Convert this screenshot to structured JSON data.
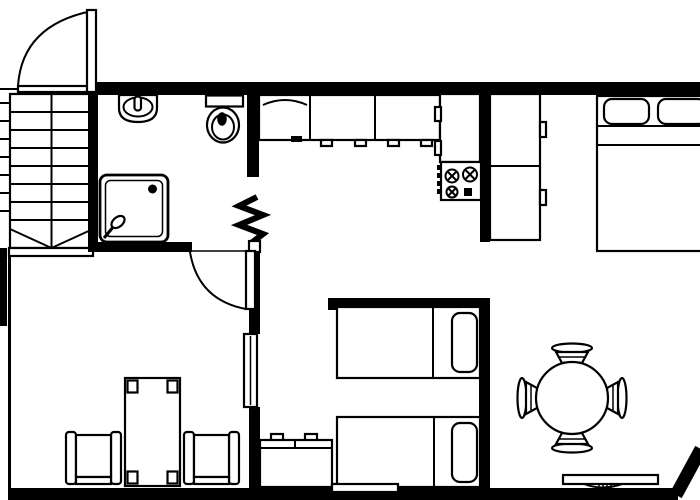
{
  "app": {
    "type": "apartment-floor-plan",
    "title": "Apartment floor plan drawing"
  },
  "canvas": {
    "width": 700,
    "height": 500,
    "background": "#ffffff",
    "line_color": "#000000"
  },
  "floorplan": {
    "rooms": [
      {
        "name": "staircase",
        "fixtures": [
          "stairs",
          "stair-run-divider",
          "bottom-landing-diagonals"
        ]
      },
      {
        "name": "bathroom",
        "fixtures": [
          "sink",
          "toilet",
          "shower-tray",
          "shower-drain",
          "shower-handle"
        ]
      },
      {
        "name": "kitchen",
        "fixtures": [
          "counter-with-sink-unit",
          "counter-cabinets",
          "cabinet-handles",
          "tall-cabinet",
          "stove-four-burners"
        ]
      },
      {
        "name": "closet",
        "fixtures": [
          "wardrobe-with-handles"
        ]
      },
      {
        "name": "bedroom-double",
        "fixtures": [
          "double-bed",
          "pillow",
          "pillow",
          "sheet-fold-lines"
        ]
      },
      {
        "name": "bedroom-twin",
        "fixtures": [
          "single-bed",
          "single-bed",
          "pillow",
          "pillow",
          "dresser-with-knobs",
          "threshold-strip"
        ]
      },
      {
        "name": "living-room",
        "fixtures": [
          "armchair",
          "armchair",
          "coffee-table-with-corner-pads",
          "wall-window"
        ]
      },
      {
        "name": "dining-area",
        "fixtures": [
          "round-table",
          "dining-chair",
          "dining-chair",
          "dining-chair",
          "dining-chair",
          "tv-shelf"
        ]
      }
    ],
    "symbols": [
      "entrance-door-swing-arc",
      "bathroom-door-swing-arc",
      "zigzag-break-symbol",
      "angled-corner-wall"
    ],
    "door_count": 2,
    "bed_count": 3,
    "chair_count": 6
  }
}
